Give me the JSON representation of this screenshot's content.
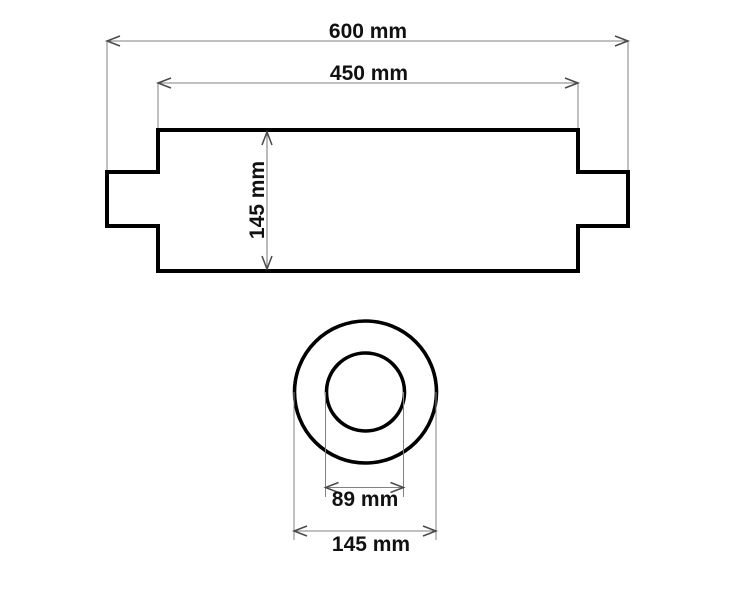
{
  "drawing": {
    "kind": "technical-dimension-drawing",
    "subject": "muffler-silencer",
    "units": "mm",
    "side_view": {
      "overall_length_mm": 600,
      "overall_length_label": "600 mm",
      "body_length_mm": 450,
      "body_length_label": "450 mm",
      "body_height_mm": 145,
      "body_height_label": "145 mm"
    },
    "end_view": {
      "inner_diameter_mm": 89,
      "inner_diameter_label": "89 mm",
      "outer_diameter_mm": 145,
      "outer_diameter_label": "145 mm"
    },
    "colors": {
      "outline": "#000000",
      "thin_line": "#828282",
      "arrow": "#4a4a4a",
      "text": "#111111",
      "background": "#ffffff"
    }
  }
}
